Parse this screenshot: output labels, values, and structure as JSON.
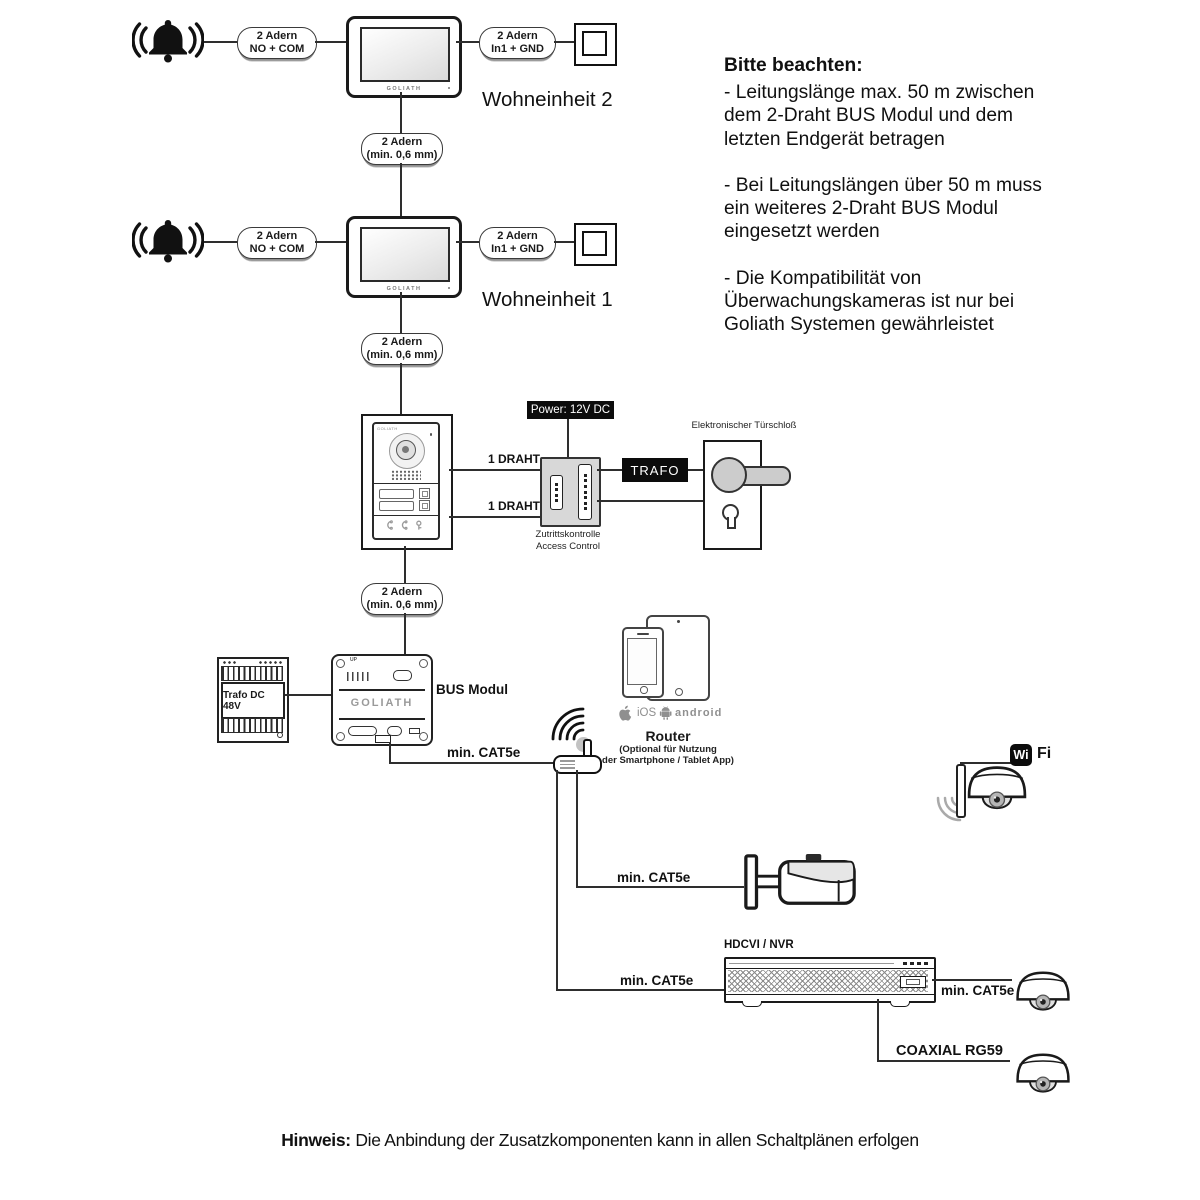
{
  "brand": "GOLIATH",
  "units": [
    {
      "label": "Wohneinheit 2"
    },
    {
      "label": "Wohneinheit 1"
    }
  ],
  "pills": {
    "bell": [
      "2 Adern",
      "NO + COM"
    ],
    "input": [
      "2 Adern",
      "In1 + GND"
    ],
    "wire": [
      "2 Adern",
      "(min. 0,6 mm)"
    ]
  },
  "door": {
    "power": "Power: 12V DC",
    "draht": "1 DRAHT",
    "access1": "Zutrittskontrolle",
    "access2": "Access Control",
    "trafo": "TRAFO",
    "lock": "Elektronischer Türschloß"
  },
  "bus": {
    "label": "BUS Modul",
    "up": "UP",
    "trafo48": "Trafo DC 48V"
  },
  "net": {
    "cat5e": "min. CAT5e",
    "coax": "COAXIAL RG59",
    "nvr": "HDCVI / NVR",
    "router_title": "Router",
    "router_sub1": "(Optional für Nutzung",
    "router_sub2": "der Smartphone / Tablet App)",
    "ios": "iOS",
    "android": "android",
    "wi": "Wi",
    "fi": "Fi"
  },
  "notes": {
    "heading": "Bitte beachten:",
    "items": [
      "- Leitungslänge max. 50 m zwischen dem 2-Draht BUS Modul und dem letzten Endgerät betragen",
      "- Bei Leitungslängen über 50 m muss ein weiteres 2-Draht BUS Modul eingesetzt werden",
      "- Die Kompatibilität von Überwachungskameras ist nur bei Goliath Systemen gewährleistet"
    ]
  },
  "footer": {
    "bold": "Hinweis:",
    "text": " Die Anbindung der Zusatzkomponenten kann in allen Schaltplänen erfolgen"
  }
}
